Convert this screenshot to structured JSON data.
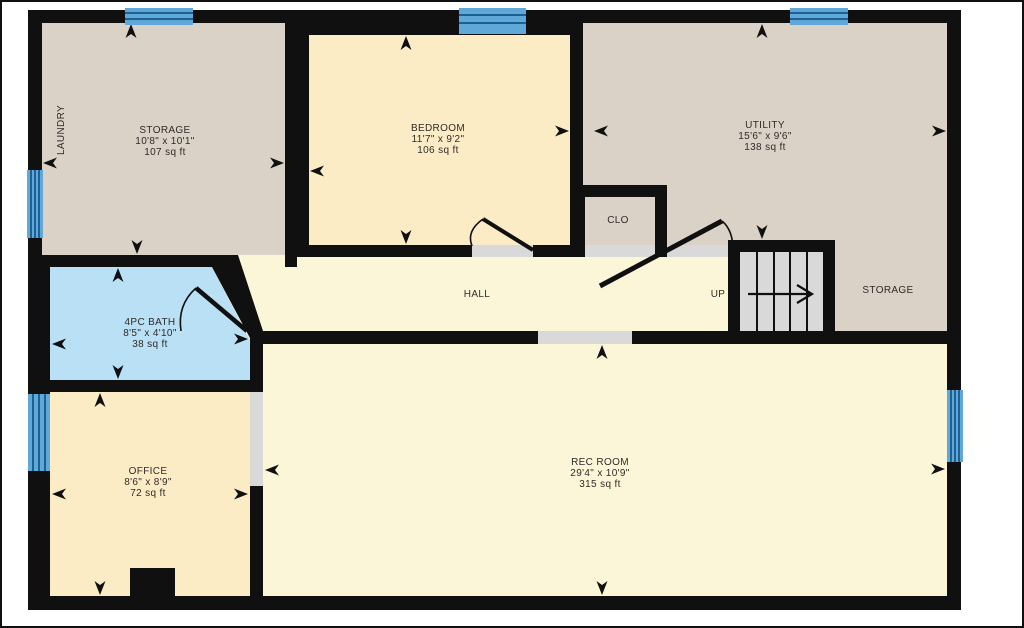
{
  "title": "Basement Floor Plan",
  "colors": {
    "wall": "#101010",
    "floor_tan": "#dad2c6",
    "floor_cream": "#fbecc6",
    "floor_pale": "#fcf6d9",
    "floor_bath": "#b9e0f5",
    "window_fill": "#5fa8d8",
    "window_line": "#1d6094",
    "opening": "#d9d9d9",
    "tread": "#d9d9d9",
    "label": "#2f2b28"
  },
  "rooms": {
    "storage_left": {
      "name": "STORAGE",
      "dims": "10'8\" x 10'1\"",
      "area": "107 sq ft"
    },
    "bedroom": {
      "name": "BEDROOM",
      "dims": "11'7\" x 9'2\"",
      "area": "106 sq ft"
    },
    "utility": {
      "name": "UTILITY",
      "dims": "15'6\" x 9'6\"",
      "area": "138 sq ft"
    },
    "bath": {
      "name": "4PC BATH",
      "dims": "8'5\" x 4'10\"",
      "area": "38 sq ft"
    },
    "office": {
      "name": "OFFICE",
      "dims": "8'6\" x 8'9\"",
      "area": "72 sq ft"
    },
    "rec_room": {
      "name": "REC ROOM",
      "dims": "29'4\" x 10'9\"",
      "area": "315 sq ft"
    },
    "hall": {
      "name": "HALL"
    },
    "closet": {
      "name": "CLO"
    },
    "storage_right": {
      "name": "STORAGE"
    },
    "laundry": {
      "name": "LAUNDRY"
    },
    "stairs": {
      "name": "UP"
    }
  }
}
